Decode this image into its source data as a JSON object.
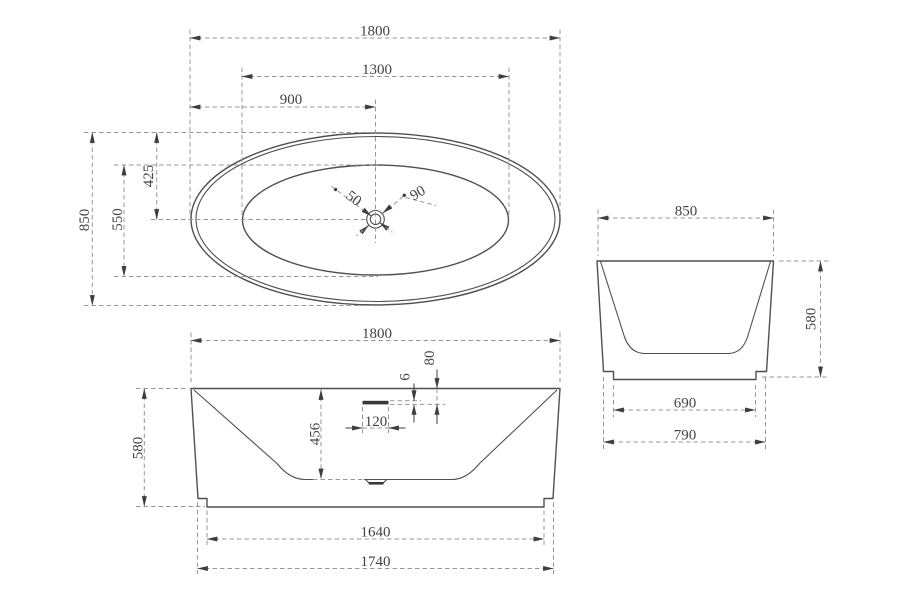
{
  "colors": {
    "background": "#ffffff",
    "outline": "#4f4f4f",
    "dimension": "#979797",
    "arrow": "#3d3d3d",
    "text": "#434343",
    "slot_fill": "#383838"
  },
  "views": {
    "top": {
      "dims": {
        "overall_length": "1800",
        "rim_length": "1300",
        "drain_from_left": "900",
        "overall_width": "850",
        "rim_width": "550",
        "center_from_top": "425",
        "drain_hole_diameter": "50",
        "drain_flange_diameter": "90"
      }
    },
    "front": {
      "dims": {
        "overall_length": "1800",
        "overflow_from_rim": "80",
        "overflow_slot_thickness": "6",
        "overflow_slot_width": "120",
        "inner_depth": "456",
        "overall_height": "580",
        "base_length": "1640",
        "bottom_length": "1740"
      }
    },
    "side": {
      "dims": {
        "overall_width": "850",
        "overall_height": "580",
        "base_width": "690",
        "bottom_width": "790"
      }
    }
  }
}
